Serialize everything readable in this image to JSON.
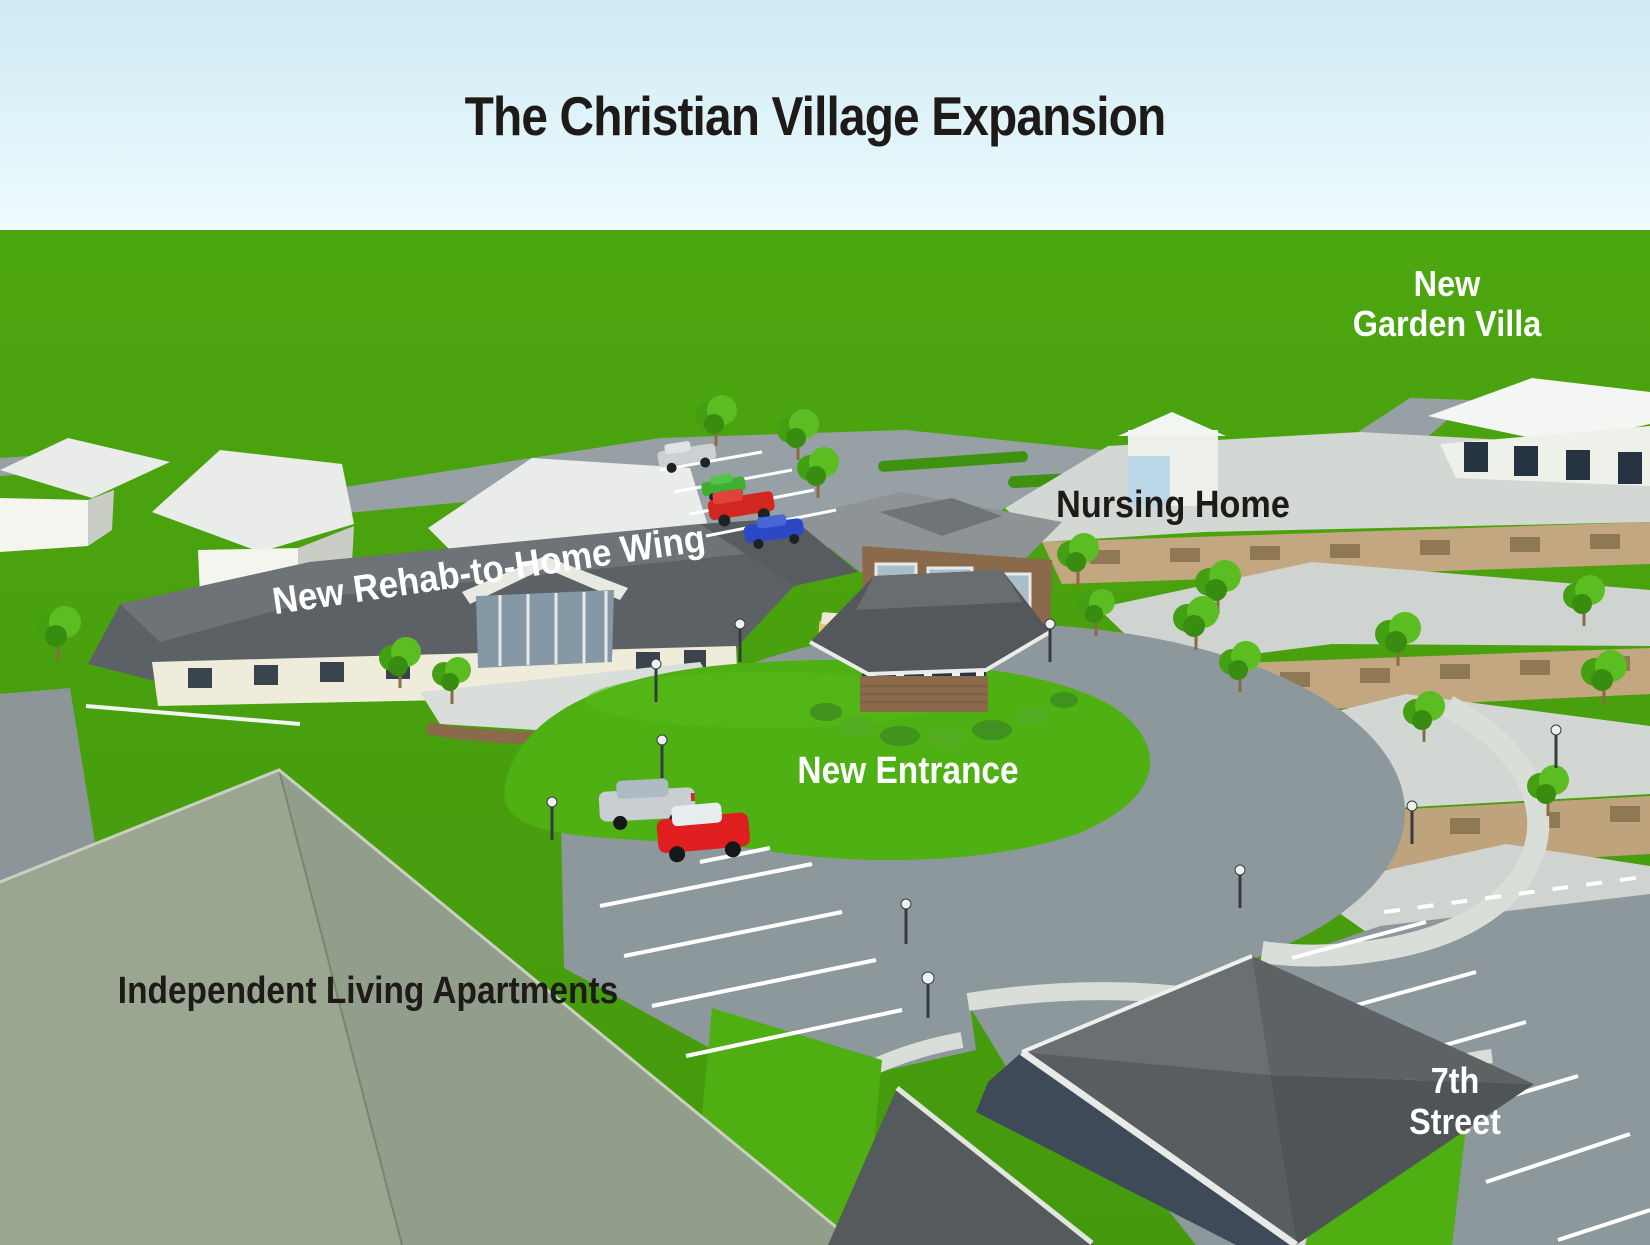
{
  "title": "The Christian Village Expansion",
  "labels": {
    "garden_villa": {
      "line1": "New",
      "line2": "Garden Villa"
    },
    "nursing_home": {
      "text": "Nursing Home"
    },
    "rehab_wing": {
      "text": "New Rehab-to-Home Wing"
    },
    "new_entrance": {
      "text": "New Entrance"
    },
    "independent_living": {
      "text": "Independent Living Apartments"
    },
    "seventh_street": {
      "line1": "7th",
      "line2": "Street"
    }
  },
  "colors": {
    "sky_top": "#cfeaf4",
    "sky_horizon": "#f2fcfe",
    "grass": "#4aa00e",
    "lawn_bright": "#4fb013",
    "road": "#8d989d",
    "road_light": "#97a1a5",
    "sidewalk": "#d9ded9",
    "roof_white": "#e9ece8",
    "roof_light_gray": "#d2d6d2",
    "roof_dark": "#5b6164",
    "roof_charcoal": "#54585a",
    "wall_cream": "#efecdc",
    "wall_white": "#f3f5f0",
    "wall_tan": "#c3a780",
    "brick": "#8a6a4b",
    "foreground_roof_left": "#9ba692",
    "foreground_roof_right": "#919e8b",
    "label_dark": "#1d1a18",
    "label_white": "#ffffff",
    "car_red": "#df1f1f",
    "car_blue": "#2b49c4",
    "car_green": "#3db031",
    "car_silver": "#c9ced2",
    "tree_green": "#4aa718",
    "parking_line": "#ffffff"
  }
}
